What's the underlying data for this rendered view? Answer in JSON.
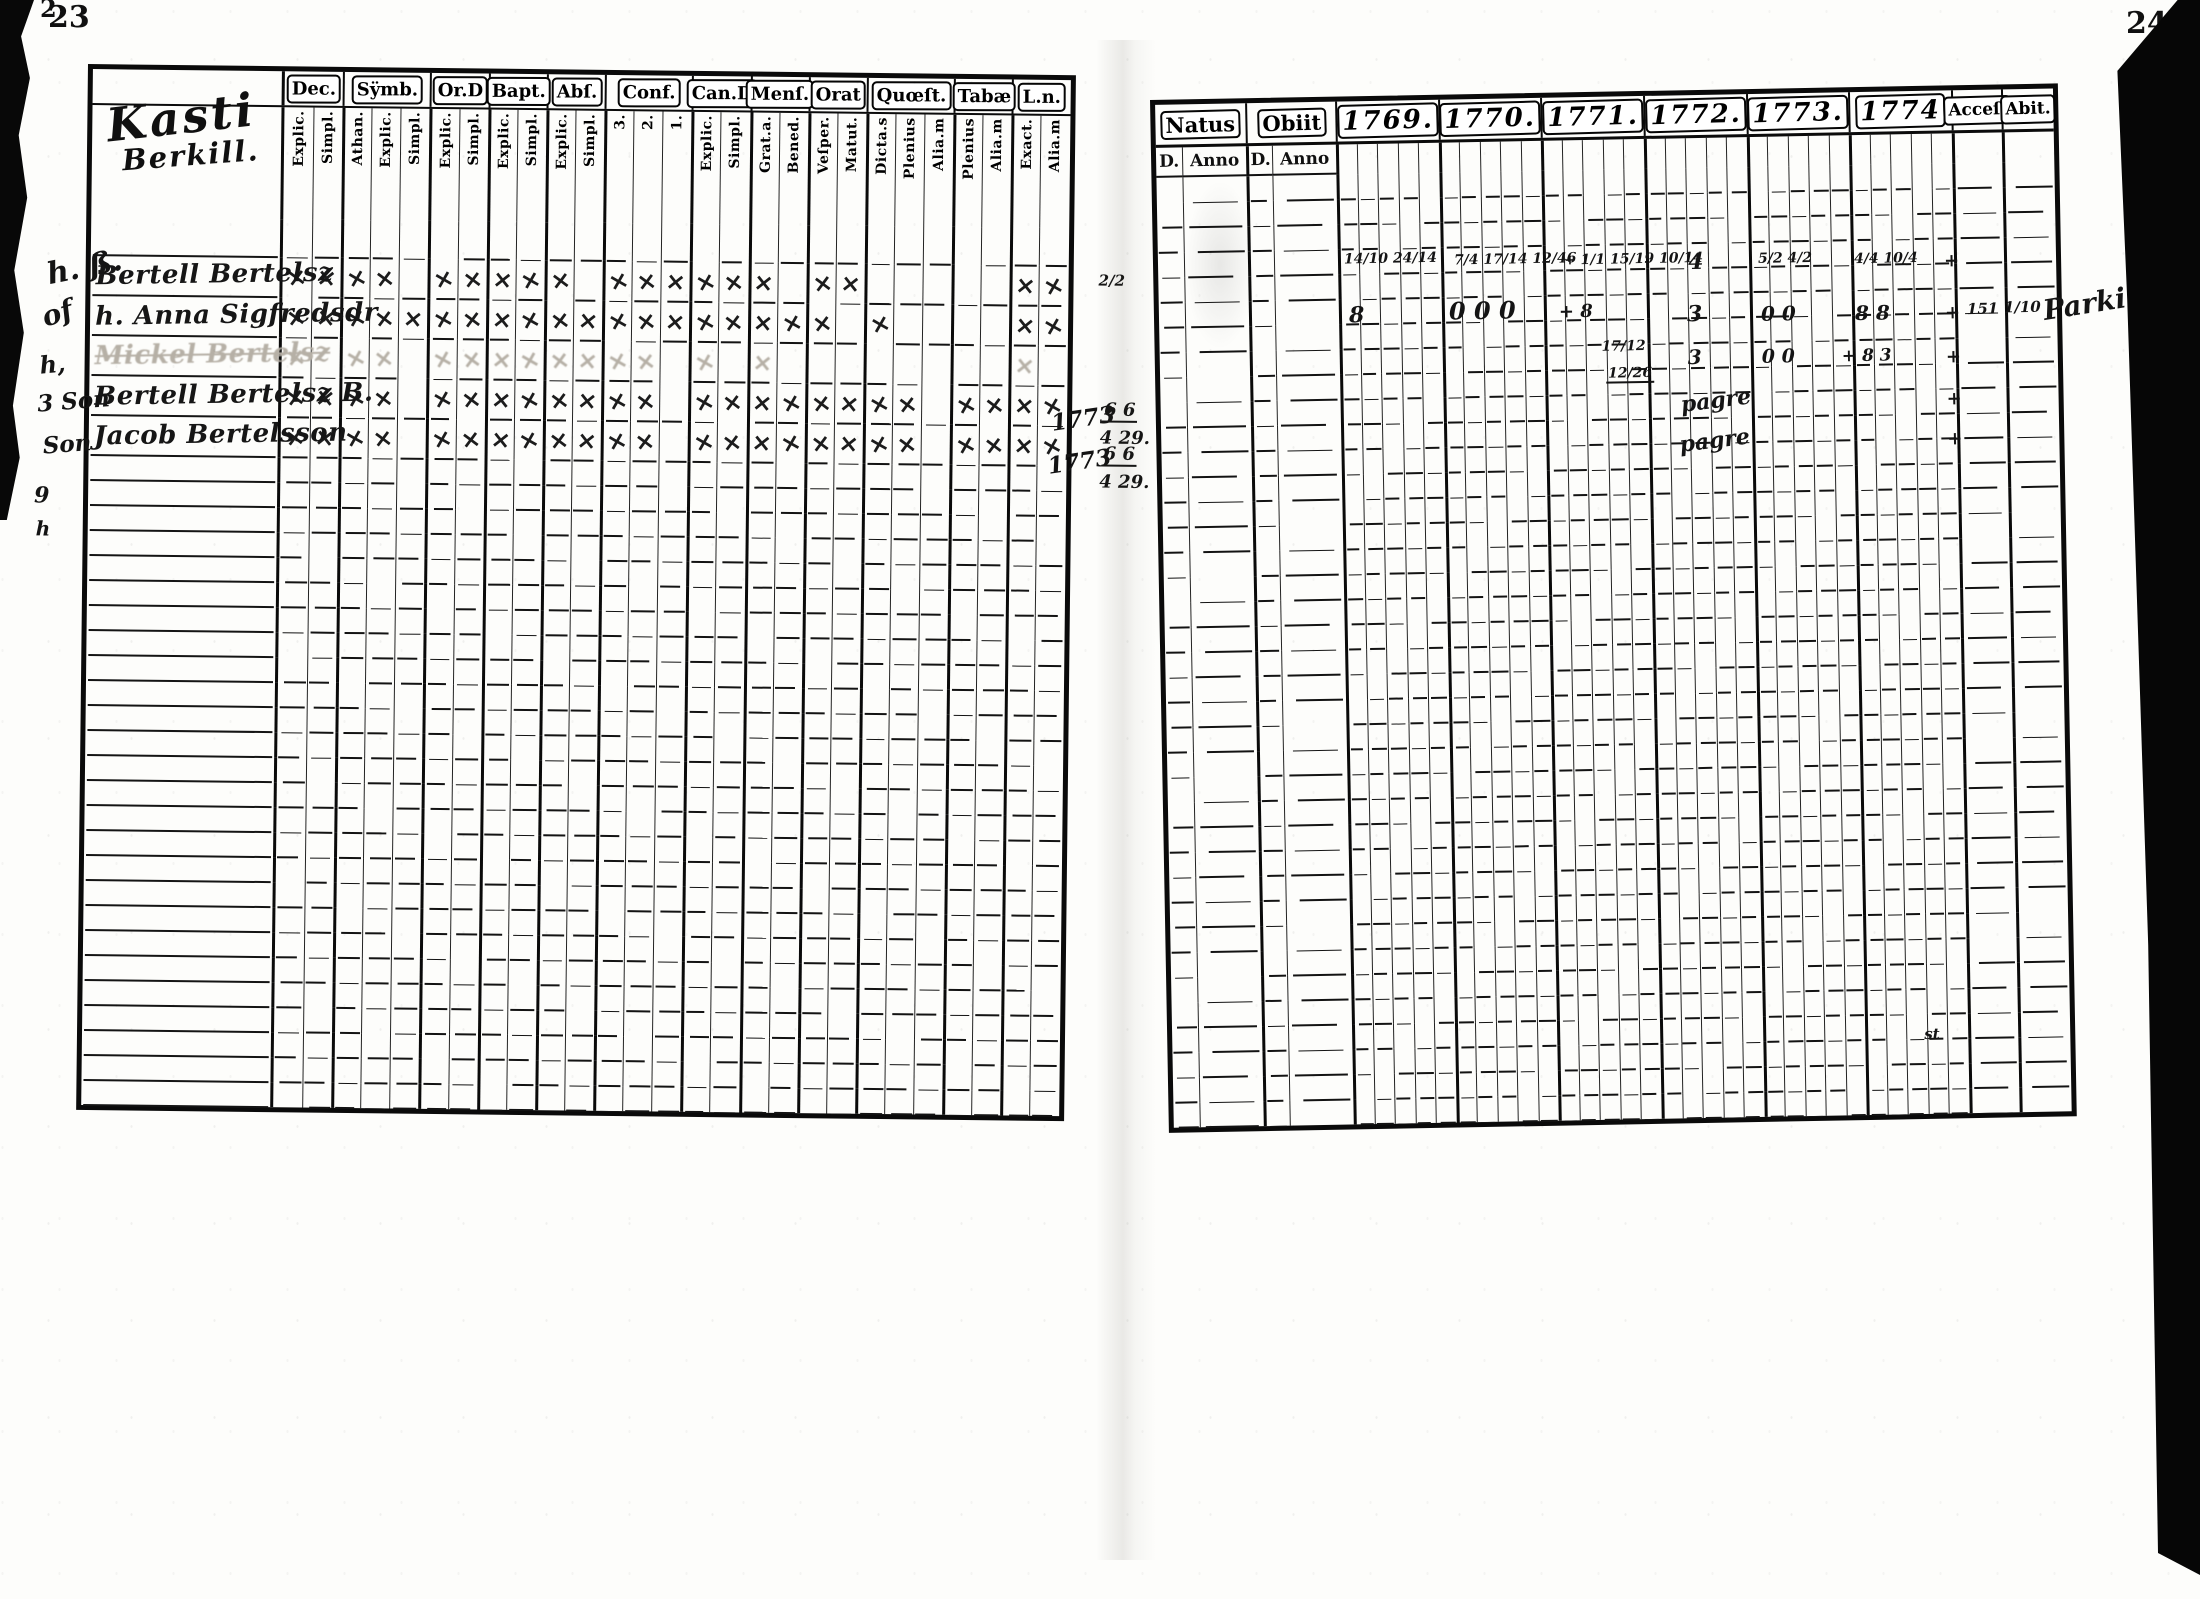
{
  "page": {
    "left_number": "23",
    "right_number": "24",
    "corner_mark": "2"
  },
  "colors": {
    "ink": "#141414",
    "paper": "#fdfdfb",
    "faded_ink": "#b6b0a6"
  },
  "left_table": {
    "title": {
      "line1": "Kasti",
      "line2": "Berkill."
    },
    "groups": [
      {
        "label": "Dec.",
        "subs": [
          "Explic.",
          "Simpl."
        ]
      },
      {
        "label": "Sÿmb.",
        "subs": [
          "Athan.",
          "Explic.",
          "Simpl."
        ]
      },
      {
        "label": "Or.D",
        "subs": [
          "Explic.",
          "Simpl."
        ]
      },
      {
        "label": "Bapt.",
        "subs": [
          "Explic.",
          "Simpl."
        ]
      },
      {
        "label": "Abſ.",
        "subs": [
          "Explic.",
          "Simpl."
        ]
      },
      {
        "label": "Conf.",
        "subs": [
          "3.",
          "2.",
          "1."
        ]
      },
      {
        "label": "Can.D",
        "subs": [
          "Explic.",
          "Simpl."
        ]
      },
      {
        "label": "Menſ.",
        "subs": [
          "Grat.a.",
          "Bened."
        ]
      },
      {
        "label": "Orat",
        "subs": [
          "Veſper.",
          "Matut."
        ]
      },
      {
        "label": "Quœſt.",
        "subs": [
          "Dicta.s",
          "Plenius",
          "Alia.m"
        ]
      },
      {
        "label": "Tabæ",
        "subs": [
          "Plenius",
          "Alia.m"
        ]
      },
      {
        "label": "L.n.",
        "subs": [
          "Exact.",
          "Alia.m"
        ]
      }
    ],
    "entries": [
      {
        "name": "Bertell Bertelsz",
        "style": "normal",
        "marks": [
          "××",
          "××",
          "××",
          "××",
          "×",
          "×××",
          "××",
          "×",
          "××",
          "",
          "",
          "××"
        ]
      },
      {
        "name": "h. Anna Sigfredsdr",
        "style": "normal",
        "marks": [
          "××",
          "×××",
          "××",
          "××",
          "××",
          "×××",
          "××",
          "××",
          "×",
          "×",
          "",
          "××"
        ]
      },
      {
        "name": "Mickel Bertelsz",
        "style": "faded",
        "marks": [
          "×",
          "××",
          "××",
          "××",
          "××",
          "××",
          "×",
          "×",
          "",
          "",
          "",
          "×"
        ]
      },
      {
        "name": "Bertell Bertelsz B.",
        "style": "normal",
        "marks": [
          "××",
          "××",
          "××",
          "××",
          "××",
          "××",
          "××",
          "××",
          "××",
          "××",
          "××",
          "××"
        ]
      },
      {
        "name": "Jacob Bertelsson",
        "style": "normal",
        "marks": [
          "××",
          "××",
          "××",
          "××",
          "××",
          "××",
          "××",
          "××",
          "××",
          "××",
          "××",
          "××"
        ]
      }
    ],
    "empty_row_count": 26
  },
  "right_table": {
    "natus": {
      "label": "Natus",
      "subs": [
        "D.",
        "Anno"
      ]
    },
    "obiit": {
      "label": "Obiit",
      "subs": [
        "D.",
        "Anno"
      ]
    },
    "years": [
      "1769.",
      "1770.",
      "1771.",
      "1772.",
      "1773.",
      "1774"
    ],
    "year_subcols": 5,
    "accel": "Acceſ.",
    "abit": "Abit.",
    "empty_row_count": 38
  },
  "annotations": {
    "left": [
      {
        "text": "h. ß.",
        "x": -44,
        "y": 184,
        "size": 30,
        "rot": -12
      },
      {
        "text": "of",
        "x": -48,
        "y": 231,
        "size": 28,
        "rot": -18
      },
      {
        "text": "h,",
        "x": -50,
        "y": 284,
        "size": 24,
        "rot": -6
      },
      {
        "text": "3 Son",
        "x": -52,
        "y": 321,
        "size": 23,
        "rot": -5
      },
      {
        "text": "Son",
        "x": -46,
        "y": 364,
        "size": 23,
        "rot": -5
      },
      {
        "text": "9",
        "x": -54,
        "y": 416,
        "size": 22,
        "rot": 0
      },
      {
        "text": "h",
        "x": -52,
        "y": 450,
        "size": 20,
        "rot": 0
      },
      {
        "text": "2/2",
        "x": 1008,
        "y": 193,
        "size": 15,
        "rot": 0
      },
      {
        "text": "1773",
        "x": 962,
        "y": 327,
        "size": 23,
        "rot": -9
      },
      {
        "text": "6 6",
        "x": 1013,
        "y": 321,
        "size": 18,
        "rot": 0,
        "cls": "bar"
      },
      {
        "text": "4 29.",
        "x": 1011,
        "y": 349,
        "size": 18,
        "rot": 0
      },
      {
        "text": "1773",
        "x": 959,
        "y": 370,
        "size": 23,
        "rot": -9
      },
      {
        "text": "6 6",
        "x": 1013,
        "y": 365,
        "size": 18,
        "rot": 0,
        "cls": "bar"
      },
      {
        "text": "4 29.",
        "x": 1011,
        "y": 393,
        "size": 18,
        "rot": 0
      }
    ],
    "right": [
      {
        "text": "14/10 24/14",
        "x": 186,
        "y": 151,
        "size": 14
      },
      {
        "text": "7/4 17/14 12/46",
        "x": 296,
        "y": 154,
        "size": 14
      },
      {
        "text": "+ 1/1 15/19 10/14",
        "x": 406,
        "y": 156,
        "size": 14
      },
      {
        "text": "4",
        "x": 530,
        "y": 156,
        "size": 22
      },
      {
        "text": "5/2 4/2",
        "x": 600,
        "y": 158,
        "size": 14
      },
      {
        "text": "4/4 10/4",
        "x": 696,
        "y": 160,
        "size": 14
      },
      {
        "text": "+",
        "x": 786,
        "y": 162,
        "size": 18
      },
      {
        "text": "8",
        "x": 190,
        "y": 203,
        "size": 22
      },
      {
        "text": "0 0 0",
        "x": 290,
        "y": 200,
        "size": 24
      },
      {
        "text": "+ 8",
        "x": 400,
        "y": 206,
        "size": 18
      },
      {
        "text": "3",
        "x": 528,
        "y": 208,
        "size": 22
      },
      {
        "text": "0 0",
        "x": 602,
        "y": 210,
        "size": 20
      },
      {
        "text": "8 8",
        "x": 696,
        "y": 211,
        "size": 20
      },
      {
        "text": "+",
        "x": 786,
        "y": 214,
        "size": 18
      },
      {
        "text": "151",
        "x": 808,
        "y": 212,
        "size": 15
      },
      {
        "text": "1/10",
        "x": 845,
        "y": 211,
        "size": 15
      },
      {
        "text": "Parki.",
        "x": 884,
        "y": 202,
        "size": 28,
        "rot": -8
      },
      {
        "text": "17/12",
        "x": 442,
        "y": 243,
        "size": 14
      },
      {
        "text": "12/26",
        "x": 446,
        "y": 270,
        "size": 14,
        "cls": "bar"
      },
      {
        "text": "3",
        "x": 528,
        "y": 252,
        "size": 20
      },
      {
        "text": "0 0",
        "x": 602,
        "y": 254,
        "size": 19
      },
      {
        "text": "+ 8 3",
        "x": 682,
        "y": 256,
        "size": 17
      },
      {
        "text": "+",
        "x": 786,
        "y": 258,
        "size": 18
      },
      {
        "text": "pagre",
        "x": 520,
        "y": 295,
        "size": 22,
        "rot": -6
      },
      {
        "text": "+",
        "x": 786,
        "y": 300,
        "size": 18
      },
      {
        "text": "pagre",
        "x": 518,
        "y": 335,
        "size": 22,
        "rot": -6
      },
      {
        "text": "+",
        "x": 786,
        "y": 340,
        "size": 18
      },
      {
        "text": "st",
        "x": 752,
        "y": 936,
        "size": 15
      }
    ]
  }
}
